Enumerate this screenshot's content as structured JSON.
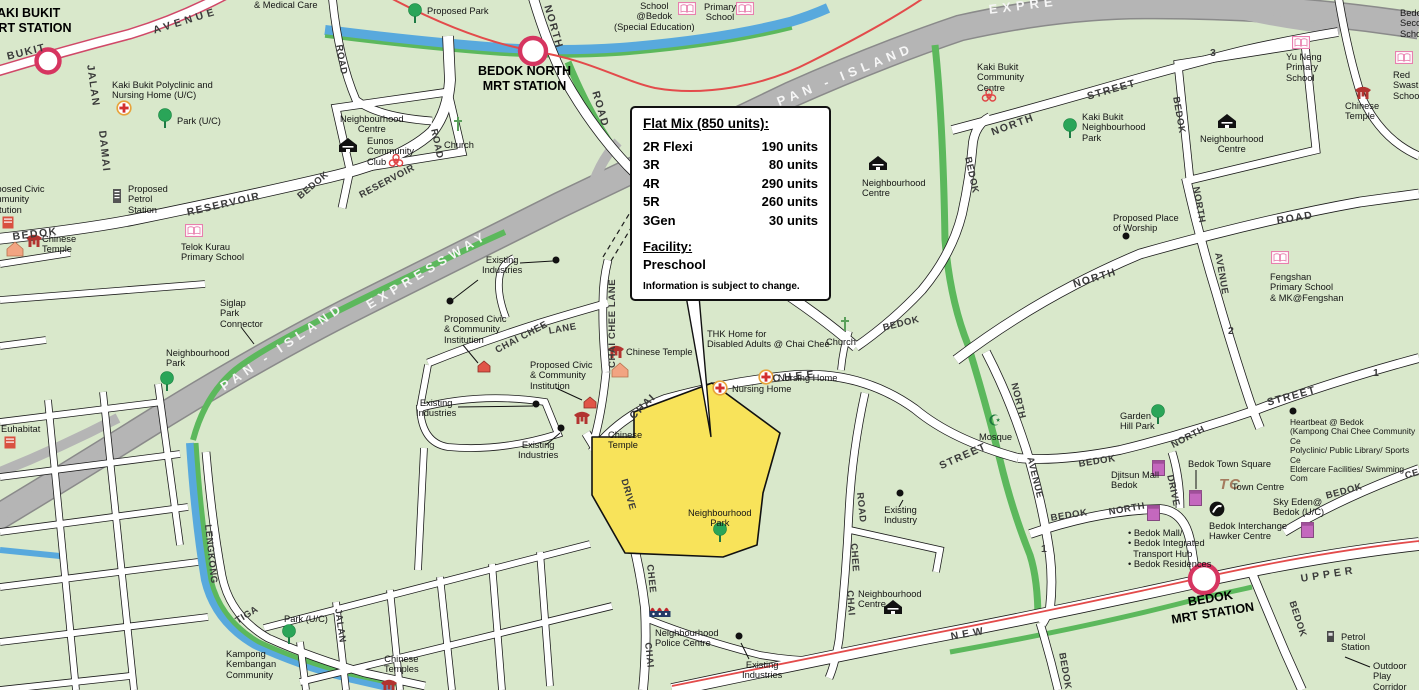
{
  "callout": {
    "title": "Flat Mix (850 units):",
    "rows": [
      {
        "type": "2R Flexi",
        "units": "190 units"
      },
      {
        "type": "3R",
        "units": "80 units"
      },
      {
        "type": "4R",
        "units": "290 units"
      },
      {
        "type": "5R",
        "units": "260 units"
      },
      {
        "type": "3Gen",
        "units": "30 units"
      }
    ],
    "facility_label": "Facility:",
    "facility_value": "Preschool",
    "disclaimer": "Information is subject to change."
  },
  "stations": {
    "kaki_bukit": "KAKI BUKIT\nMRT STATION",
    "bedok_north": "BEDOK NORTH\nMRT STATION",
    "bedok": "BEDOK\nMRT STATION"
  },
  "roads": {
    "bukit": "BUKIT",
    "kaki_avenue": "AVENUE",
    "jalan_nw": "JALAN",
    "damai": "DAMAI",
    "road_b": "ROAD",
    "north_d": "NORTH",
    "road_d": "ROAD",
    "reservoir_w": "RESERVOIR",
    "bedok_w": "BEDOK",
    "reservoir_e": "RESERVOIR",
    "road_res": "ROAD",
    "bedok_ne": "BEDOK",
    "pan_island_w": "PAN - ISLAND",
    "expressway_w": "EXPRESSWAY",
    "pan_island_e": "PAN - ISLAND",
    "expressway_e": "EXPRE",
    "chai_chee_ln": "CHAI CHEE",
    "lane": "LANE",
    "chai_chee_lane_v": "CHAI CHEE LANE",
    "chai_st": "CHAI",
    "chee_st": "CHEE",
    "street_cc": "STREET",
    "bedok_c": "BEDOK",
    "bedok_cv": "BEDOK",
    "north_st3": "NORTH",
    "street_3": "STREET",
    "num_3": "3",
    "bedok_tr": "BEDOK",
    "north_rd1": "NORTH",
    "road_ne": "ROAD",
    "north_v": "NORTH",
    "avenue_2": "AVENUE",
    "num_2": "2",
    "street_1": "STREET",
    "num_1": "1",
    "north_st1": "NORTH",
    "bedok_st1": "BEDOK",
    "bedok_nd": "BEDOK",
    "north_nd": "NORTH",
    "drive_nd": "DRIVE",
    "new_r": "NEW",
    "upper_r": "UPPER",
    "bedok_se": "BEDOK",
    "bedok_s": "BEDOK",
    "bedok_ce": "BEDOK",
    "ce": "CE",
    "road_ccr": "ROAD",
    "chee_ccr": "CHEE",
    "chai_ccr": "CHAI",
    "drive_ccd": "DRIVE",
    "chee_ccd": "CHEE",
    "chai_ccd": "CHAI",
    "lengkong": "LENGKONG",
    "tiga": "TIGA",
    "jalan_sw": "JALAN",
    "north_a1": "NORTH",
    "avenue_a1": "AVENUE",
    "num_1b": "1"
  },
  "places": {
    "medical_care": "& Medical Care",
    "kb_polyclinic": "Kaki Bukit Polyclinic and\nNursing Home (U/C)",
    "park_uc_n": "Park (U/C)",
    "prop_petrol": "Proposed\nPetrol\nStation",
    "chinese_temple_w": "Chinese\nTemple",
    "telok_kurau": "Telok Kurau\nPrimary School",
    "prop_civic_w": "Proposed Civic\nCommunity\nInstitution",
    "prop_park": "Proposed Park",
    "school_bedok": "School\n@Bedok\n(Special Education)",
    "primary_school": "Primary\nSchool",
    "nb_centre_nw": "Neighbourhood\nCentre",
    "eunos_cc": "Eunos\nCommunity\nClub",
    "church_w": "Church",
    "kaki_bukit_cc": "Kaki Bukit\nCommunity\nCentre",
    "kaki_bukit_np": "Kaki Bukit\nNeighbourhood\nPark",
    "nb_centre_ne": "Neighbourhood\nCentre",
    "yu_neng": "Yu Neng\nPrimary\nSchool",
    "chinese_temple_ne": "Chinese\nTemple",
    "red_swastika": "Red Swastika\nSchool",
    "bedok_sec": "Bedok\nSecondary\nSchool",
    "nb_centre_c": "Neighbourhood\nCentre",
    "prop_worship": "Proposed Place\nof Worship",
    "fengshan": "Fengshan\nPrimary School\n& MK@Fengshan",
    "heartbeat": "Heartbeat @ Bedok\n(Kampong Chai Chee Community Ce\nPolyclinic/ Public Library/ Sports Ce\nEldercare Facilities/ Swimming Com",
    "garden_hill": "Garden\nHill Park",
    "djitsun": "Djitsun Mall\nBedok",
    "bedok_town_sq": "Bedok Town Square",
    "town_centre": "Town Centre",
    "tc": "TC",
    "bedok_interchange": "Bedok Interchange\nHawker Centre",
    "sky_eden": "Sky Eden@\nBedok (U/C)",
    "bedok_mall_list": "• Bedok Mall/\n• Bedok Integrated\n  Transport Hub\n• Bedok Residences",
    "petrol_station": "Petrol\nStation",
    "outdoor_play": "Outdoor\nPlay Corridor",
    "existing_ind_1": "Existing\nIndustries",
    "existing_ind_2": "Existing\nIndustries",
    "existing_ind_3": "Existing\nIndustries",
    "existing_ind_4": "Existing\nIndustries",
    "existing_industry": "Existing\nIndustry",
    "prop_civic_1": "Proposed Civic\n& Community\nInstitution",
    "prop_civic_2": "Proposed Civic\n& Community\nInstitution",
    "chinese_temple_cc": "Chinese Temple",
    "chinese_temple_site": "Chinese\nTemple",
    "nb_centre_s": "Neighbourhood\nCentre",
    "nb_park_c": "Neighbourhood\nPark",
    "nb_police": "Neighbourhood\nPolice Centre",
    "kampong": "Kampong\nKembangan\nCommunity",
    "chinese_temples_sw": "Chinese\nTemples",
    "park_uc_sw": "Park (U/C)",
    "euhabitat": "Euhabitat",
    "siglap": "Siglap\nPark\nConnector",
    "nb_park_w": "Neighbourhood\nPark",
    "thk": "THK Home for\nDisabled Adults @ Chai Chee",
    "nursing_home_1": "Nursing Home",
    "nursing_home_2": "Nursing Home",
    "church_c": "Church",
    "mosque": "Mosque"
  }
}
